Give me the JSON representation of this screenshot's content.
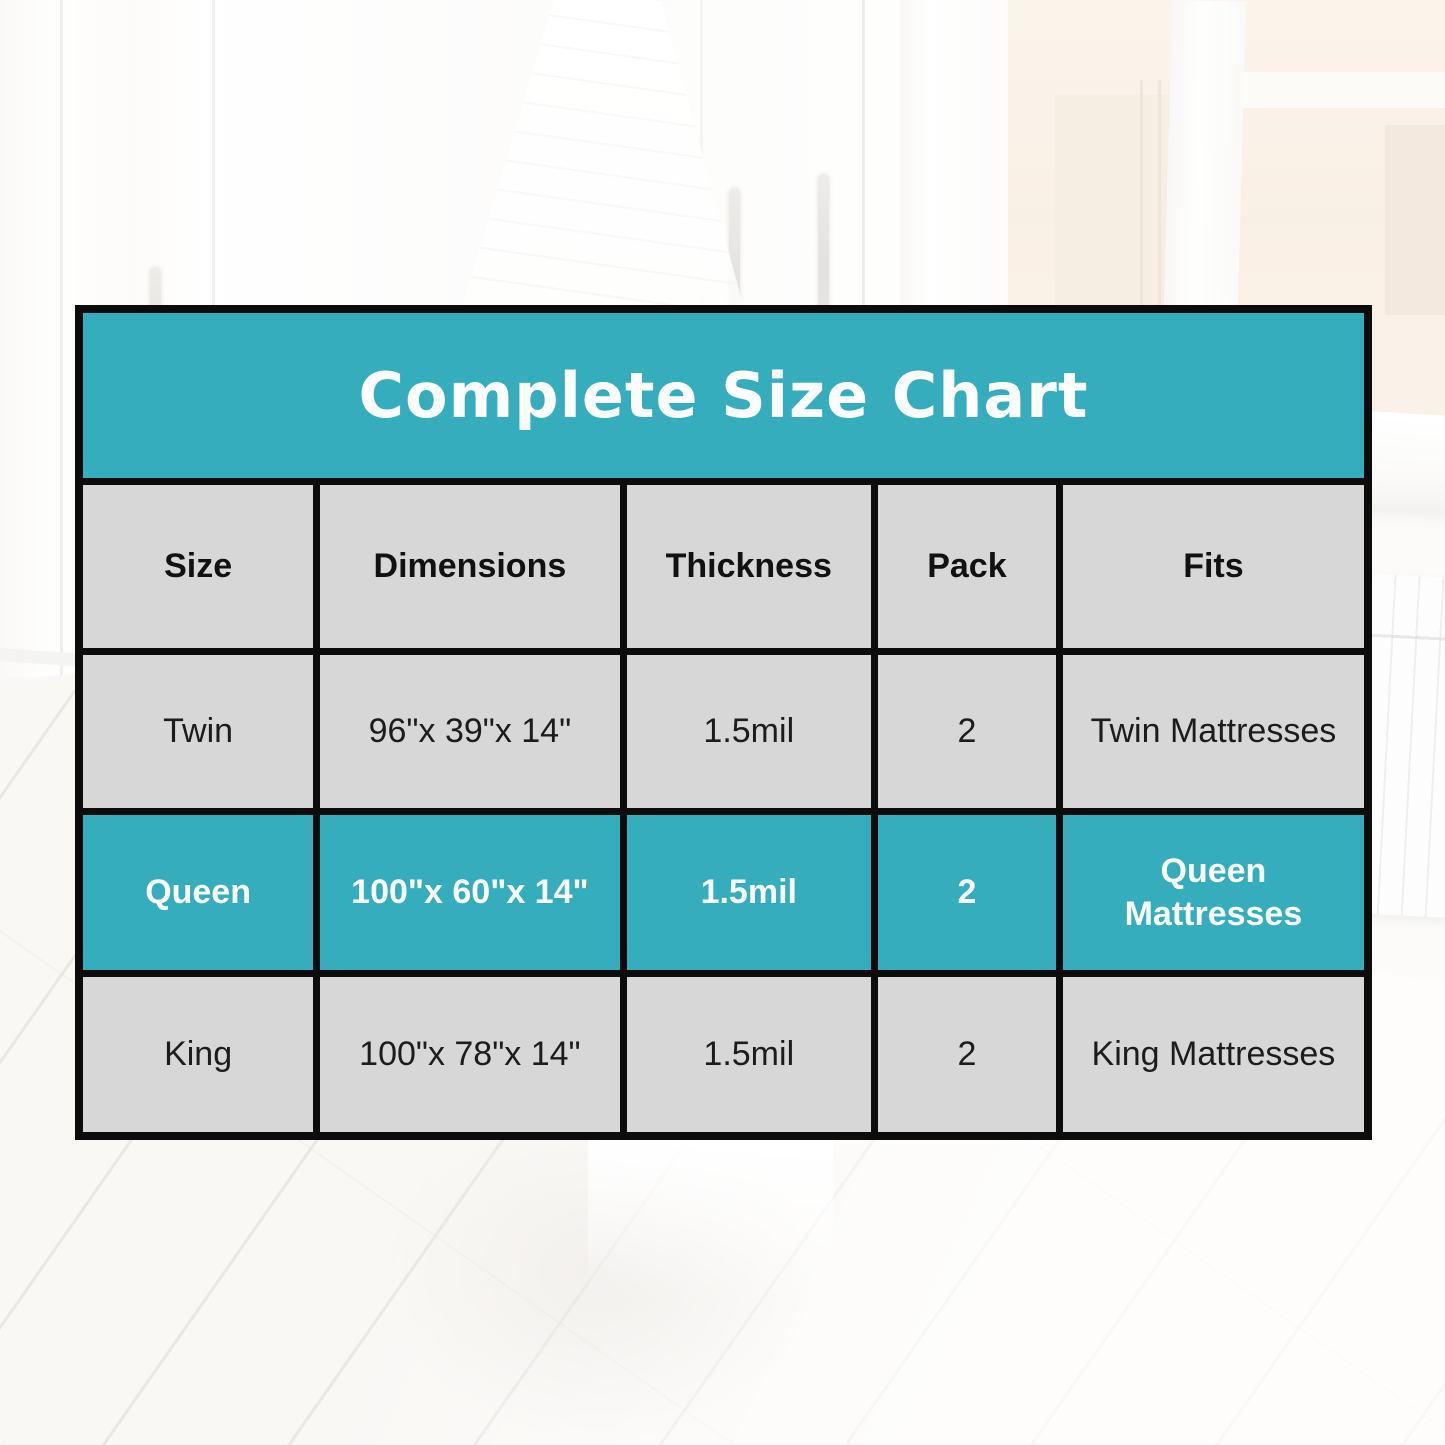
{
  "title_banner": "Complete Size Chart",
  "colors": {
    "accent_teal": "#35ADBC",
    "border_black": "#0C0C0C",
    "title_text": "#FFFFFF",
    "header_text": "#111111",
    "body_text": "#1C1C1C"
  },
  "table": {
    "headers": [
      "Size",
      "Dimensions",
      "Thickness",
      "Pack",
      "Fits"
    ],
    "rows": [
      {
        "size": "Twin",
        "dimensions": "96\"x 39\"x 14\"",
        "thickness": "1.5mil",
        "pack": "2",
        "fits": "Twin Mattresses",
        "highlighted": false
      },
      {
        "size": "Queen",
        "dimensions": "100\"x 60\"x 14\"",
        "thickness": "1.5mil",
        "pack": "2",
        "fits": "Queen Mattresses",
        "highlighted": true
      },
      {
        "size": "King",
        "dimensions": "100\"x 78\"x 14\"",
        "thickness": "1.5mil",
        "pack": "2",
        "fits": "King Mattresses",
        "highlighted": false
      }
    ]
  },
  "chart_data": {
    "type": "table",
    "title": "Complete Size Chart",
    "columns": [
      "Size",
      "Dimensions",
      "Thickness",
      "Pack",
      "Fits"
    ],
    "rows": [
      [
        "Twin",
        "96\"x 39\"x 14\"",
        "1.5mil",
        "2",
        "Twin Mattresses"
      ],
      [
        "Queen",
        "100\"x 60\"x 14\"",
        "1.5mil",
        "2",
        "Queen Mattresses"
      ],
      [
        "King",
        "100\"x 78\"x 14\"",
        "1.5mil",
        "2",
        "King Mattresses"
      ]
    ],
    "highlighted_row": "Queen",
    "layout": "merged teal title banner on top; header row; Queen data row highlighted in teal; black grid borders over faded bedroom photo"
  }
}
